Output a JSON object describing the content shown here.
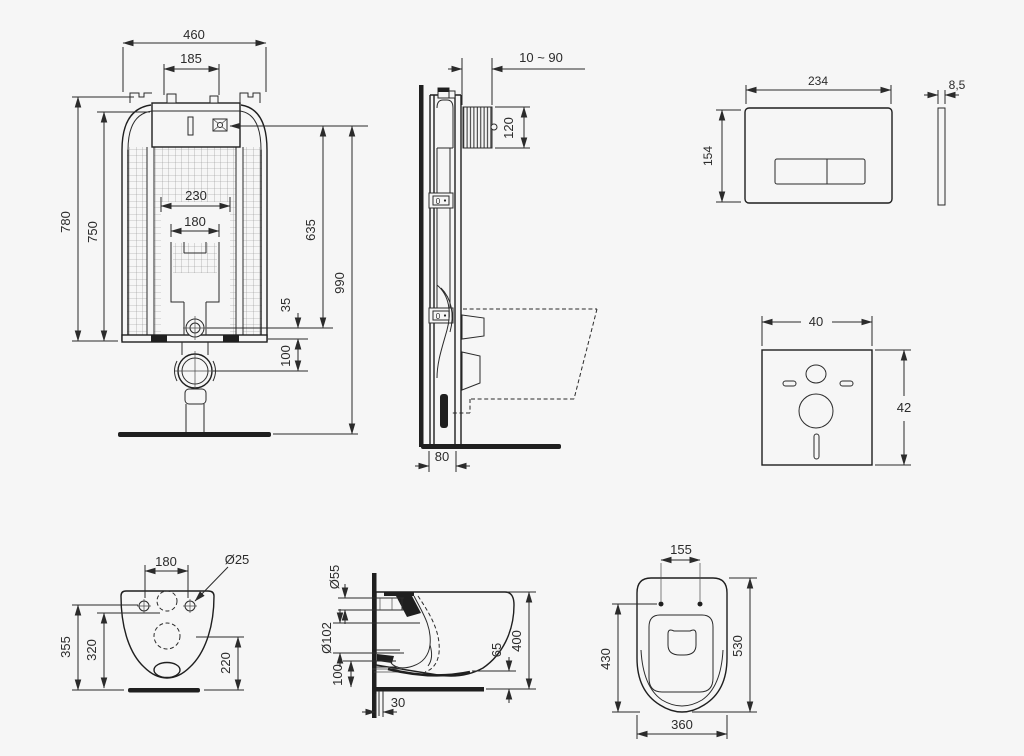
{
  "drawing": {
    "background": "#f6f6f6",
    "line_color": "#2b2b2b",
    "views": {
      "cistern_frame_front": {
        "dims": {
          "overall_width": "460",
          "hanger_spacing": "185",
          "frame_height": "780",
          "inner_height": "750",
          "cutout_width": "230",
          "bend_width": "180",
          "valve_height": "635",
          "overall_height": "990",
          "supply_offset": "35",
          "outlet_offset": "100"
        }
      },
      "cistern_frame_side": {
        "dims": {
          "wall_depth_range": "10 ~ 90",
          "plate_opening_height": "120",
          "frame_depth": "80"
        },
        "labels": {
          "adjust_marker_top": "0",
          "adjust_marker_bottom": "0"
        }
      },
      "flush_plate": {
        "dims": {
          "width": "234",
          "height": "154",
          "thickness": "8,5"
        }
      },
      "sound_insulation_mat": {
        "dims": {
          "width": "40",
          "height": "42"
        }
      },
      "bowl_rear": {
        "dims": {
          "fixing_spacing": "180",
          "fixing_hole_dia": "Ø25",
          "height_total": "355",
          "height_inner": "320",
          "outlet_height": "220"
        }
      },
      "bowl_side": {
        "dims": {
          "inlet_dia": "Ø55",
          "outlet_dia": "Ø102",
          "outlet_center_height": "100",
          "wall_offset": "30",
          "rim_clearance": "65",
          "mount_height": "400"
        }
      },
      "bowl_top": {
        "dims": {
          "hinge_spacing": "155",
          "bowl_length": "430",
          "total_length": "530",
          "width": "360"
        }
      }
    }
  }
}
